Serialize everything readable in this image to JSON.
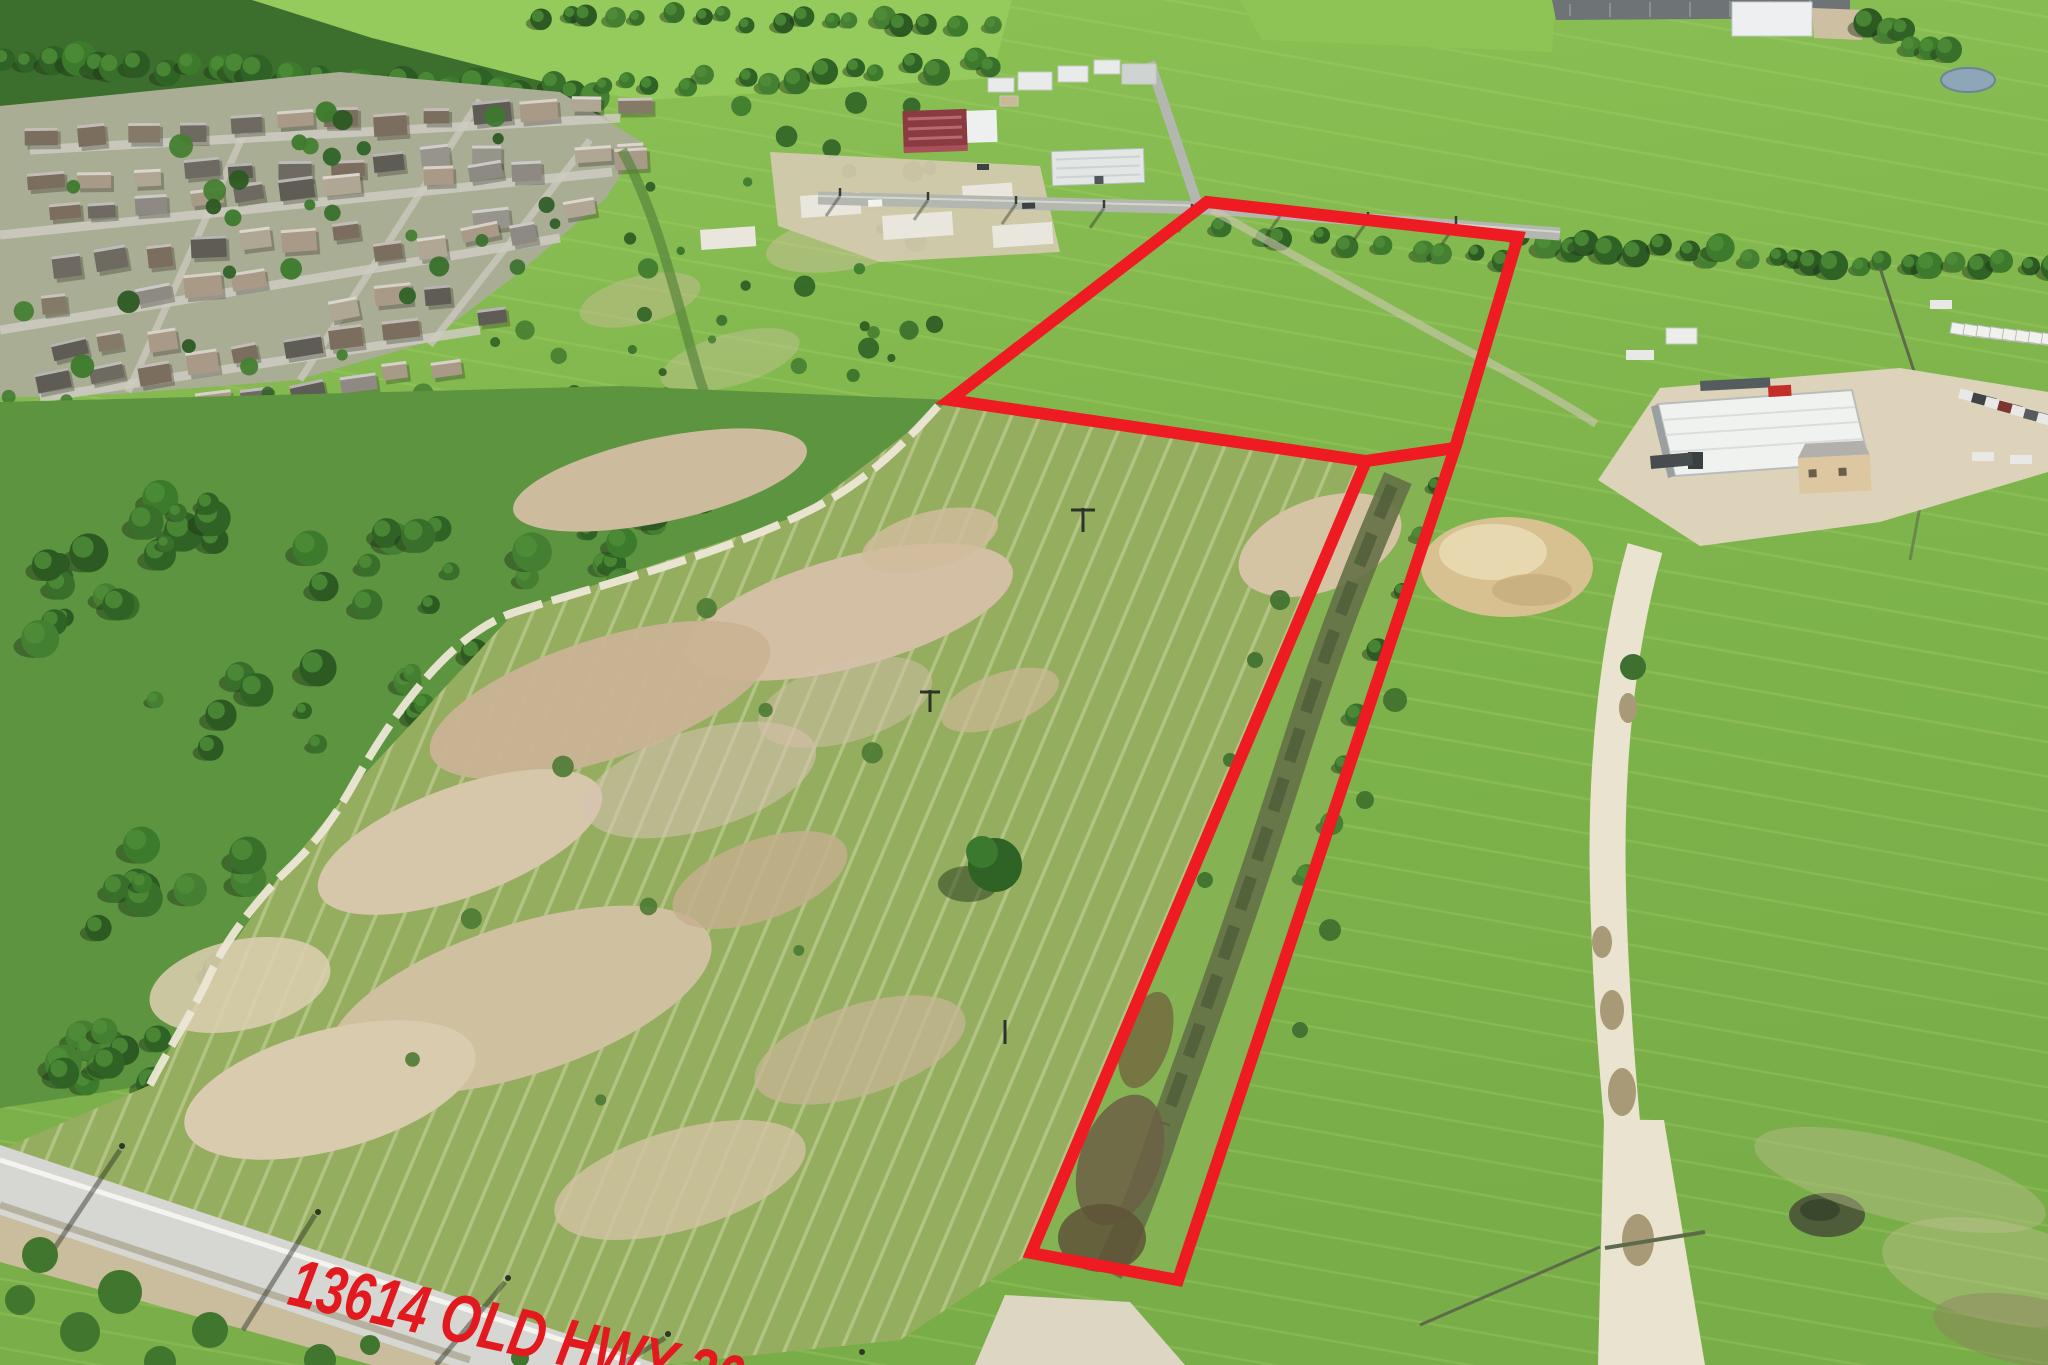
{
  "image": {
    "kind": "aerial-drone-real-estate-photo",
    "width_px": 2048,
    "height_px": 1365
  },
  "annotations": {
    "address_label": "13614 OLD HWY 20",
    "label_color": "#e2191f",
    "boundary_color": "#ee1b23",
    "boundary_stroke_px": 12,
    "parcels": [
      {
        "name": "north-parcel",
        "points": "950,400 1207,202 1518,237 1455,448 1366,461"
      },
      {
        "name": "roadside-strip-parcel",
        "points": "1366,461 1455,448 1178,1280 1031,1253"
      }
    ]
  },
  "scene": {
    "description": "Vacant acreage outlined in red along Old Hwy 20: a cleared field with bare-dirt patches and a narrow grass strip with a muddy track, suburban subdivision at upper left, cedar scrub woodland on the left, industrial buildings and warehouses along the top and right, bright green pastures, a white dirt road, dirt mound and parked trucks on the right, paved highway across the lower left.",
    "palette": {
      "pasture_green": "#82bb4d",
      "bright_field_green": "#95ca5c",
      "cleared_field_green": "#94ad5e",
      "woodland_green": "#3c6e2d",
      "cleared_dirt_tan": "#cfbc9d",
      "dirt_road_tan": "#e7e1cc",
      "asphalt_gray": "#d6d7d2",
      "roof_white": "#f0f2f0",
      "maroon_building": "#8c3a42"
    }
  }
}
